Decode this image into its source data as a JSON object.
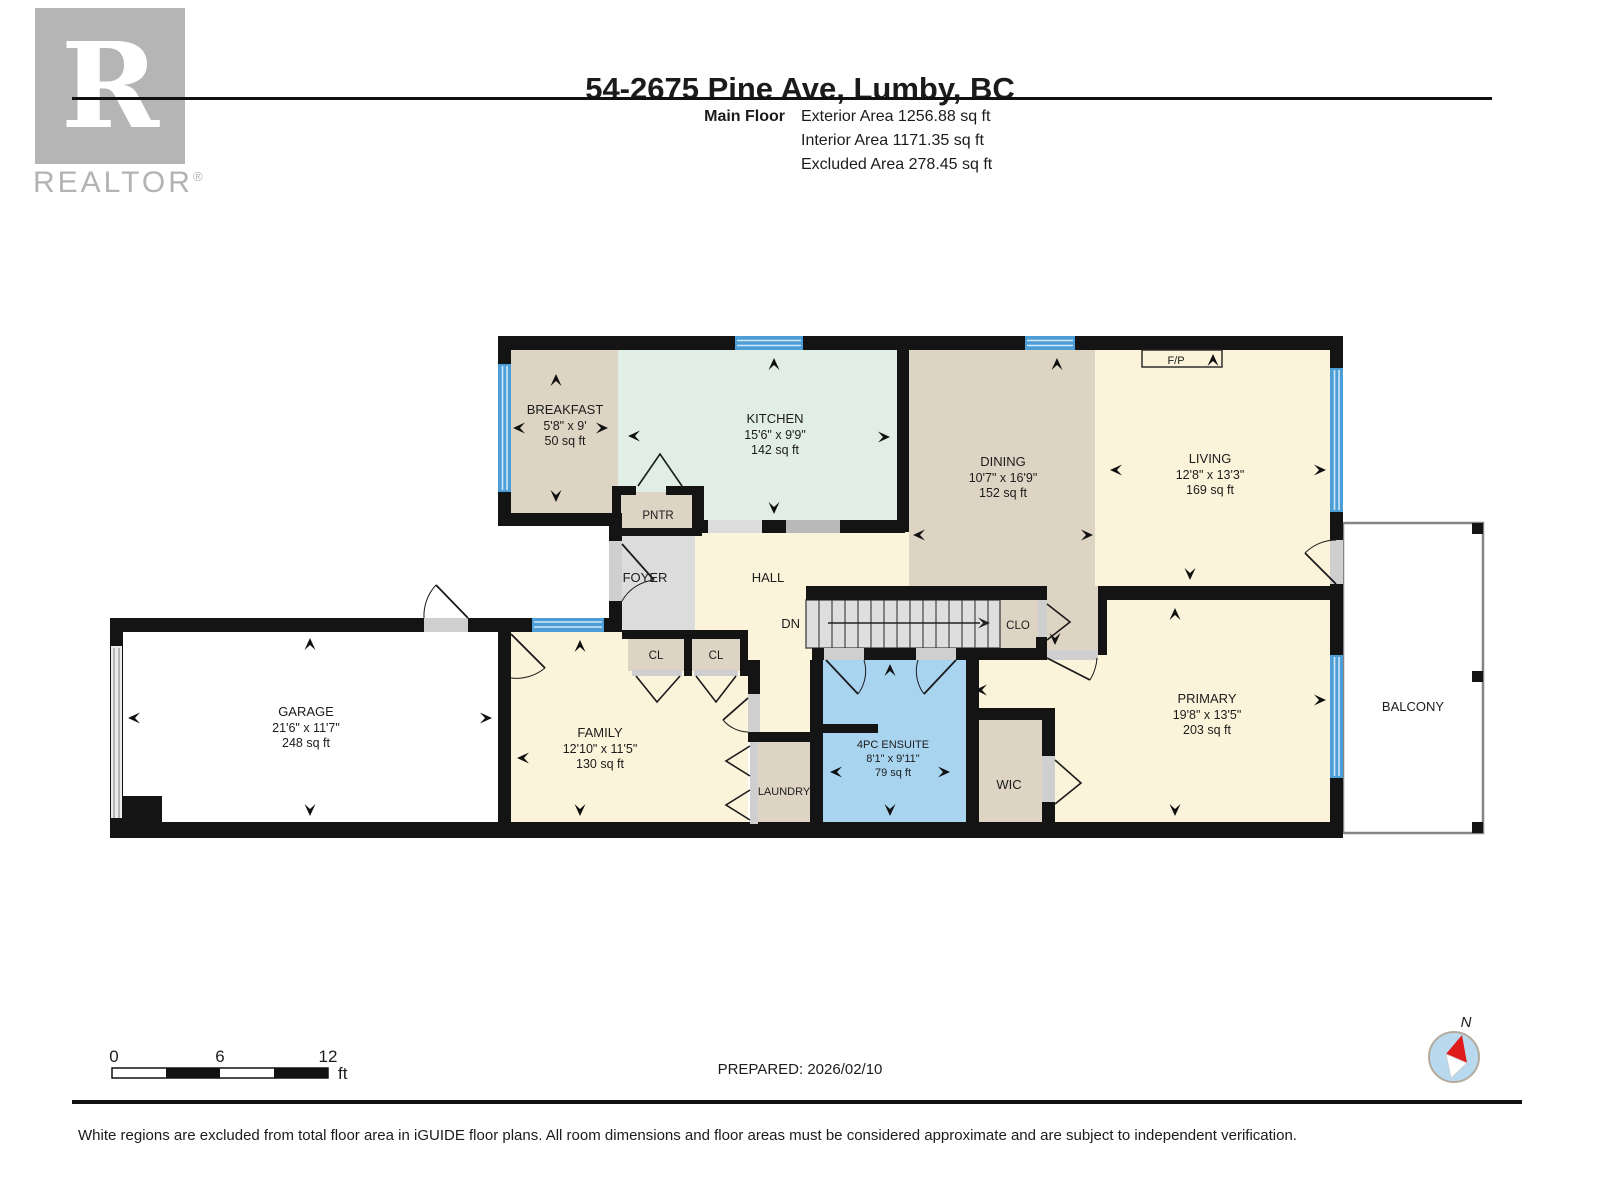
{
  "header": {
    "title": "54-2675 Pine Ave, Lumby, BC",
    "floor_label": "Main Floor",
    "stats": [
      "Exterior Area 1256.88 sq ft",
      "Interior Area 1171.35 sq ft",
      "Excluded Area 278.45 sq ft"
    ]
  },
  "logo": {
    "letter": "R",
    "wordmark": "REALTOR",
    "registered": "®"
  },
  "rooms": {
    "breakfast": {
      "name": "BREAKFAST",
      "dims": "5'8\" x 9'",
      "area": "50 sq ft"
    },
    "kitchen": {
      "name": "KITCHEN",
      "dims": "15'6\" x 9'9\"",
      "area": "142 sq ft"
    },
    "dining": {
      "name": "DINING",
      "dims": "10'7\" x 16'9\"",
      "area": "152 sq ft"
    },
    "living": {
      "name": "LIVING",
      "dims": "12'8\" x 13'3\"",
      "area": "169 sq ft"
    },
    "garage": {
      "name": "GARAGE",
      "dims": "21'6\" x 11'7\"",
      "area": "248 sq ft"
    },
    "family": {
      "name": "FAMILY",
      "dims": "12'10\" x 11'5\"",
      "area": "130 sq ft"
    },
    "primary": {
      "name": "PRIMARY",
      "dims": "19'8\" x 13'5\"",
      "area": "203 sq ft"
    },
    "ensuite": {
      "name": "4PC ENSUITE",
      "dims": "8'1\" x 9'11\"",
      "area": "79 sq ft"
    },
    "wic": {
      "name": "WIC"
    },
    "laundry": {
      "name": "LAUNDRY"
    },
    "pntr": {
      "name": "PNTR"
    },
    "foyer": {
      "name": "FOYER"
    },
    "hall": {
      "name": "HALL"
    },
    "stairs": {
      "label": "DN"
    },
    "clo": {
      "name": "CLO"
    },
    "cl_a": {
      "name": "CL"
    },
    "cl_b": {
      "name": "CL"
    },
    "balcony": {
      "name": "BALCONY"
    },
    "fireplace": {
      "name": "F/P"
    }
  },
  "scale_bar": {
    "start": "0",
    "mid": "6",
    "end": "12",
    "unit": "ft"
  },
  "prepared": "PREPARED: 2026/02/10",
  "compass": {
    "north": "N"
  },
  "disclaimer": "White regions are excluded from total floor area in iGUIDE floor plans. All room dimensions and floor areas must be considered approximate and are subject to independent verification.",
  "colors": {
    "wall": "#141414",
    "tan": "#ded4c3",
    "mint": "#e1eee6",
    "yellow": "#fbf4da",
    "ensuite_blue": "#a9d4f0",
    "foyer_gray": "#dcdcdc",
    "stairs_gray": "#dedede",
    "window_blue": "#4d9ed7"
  }
}
